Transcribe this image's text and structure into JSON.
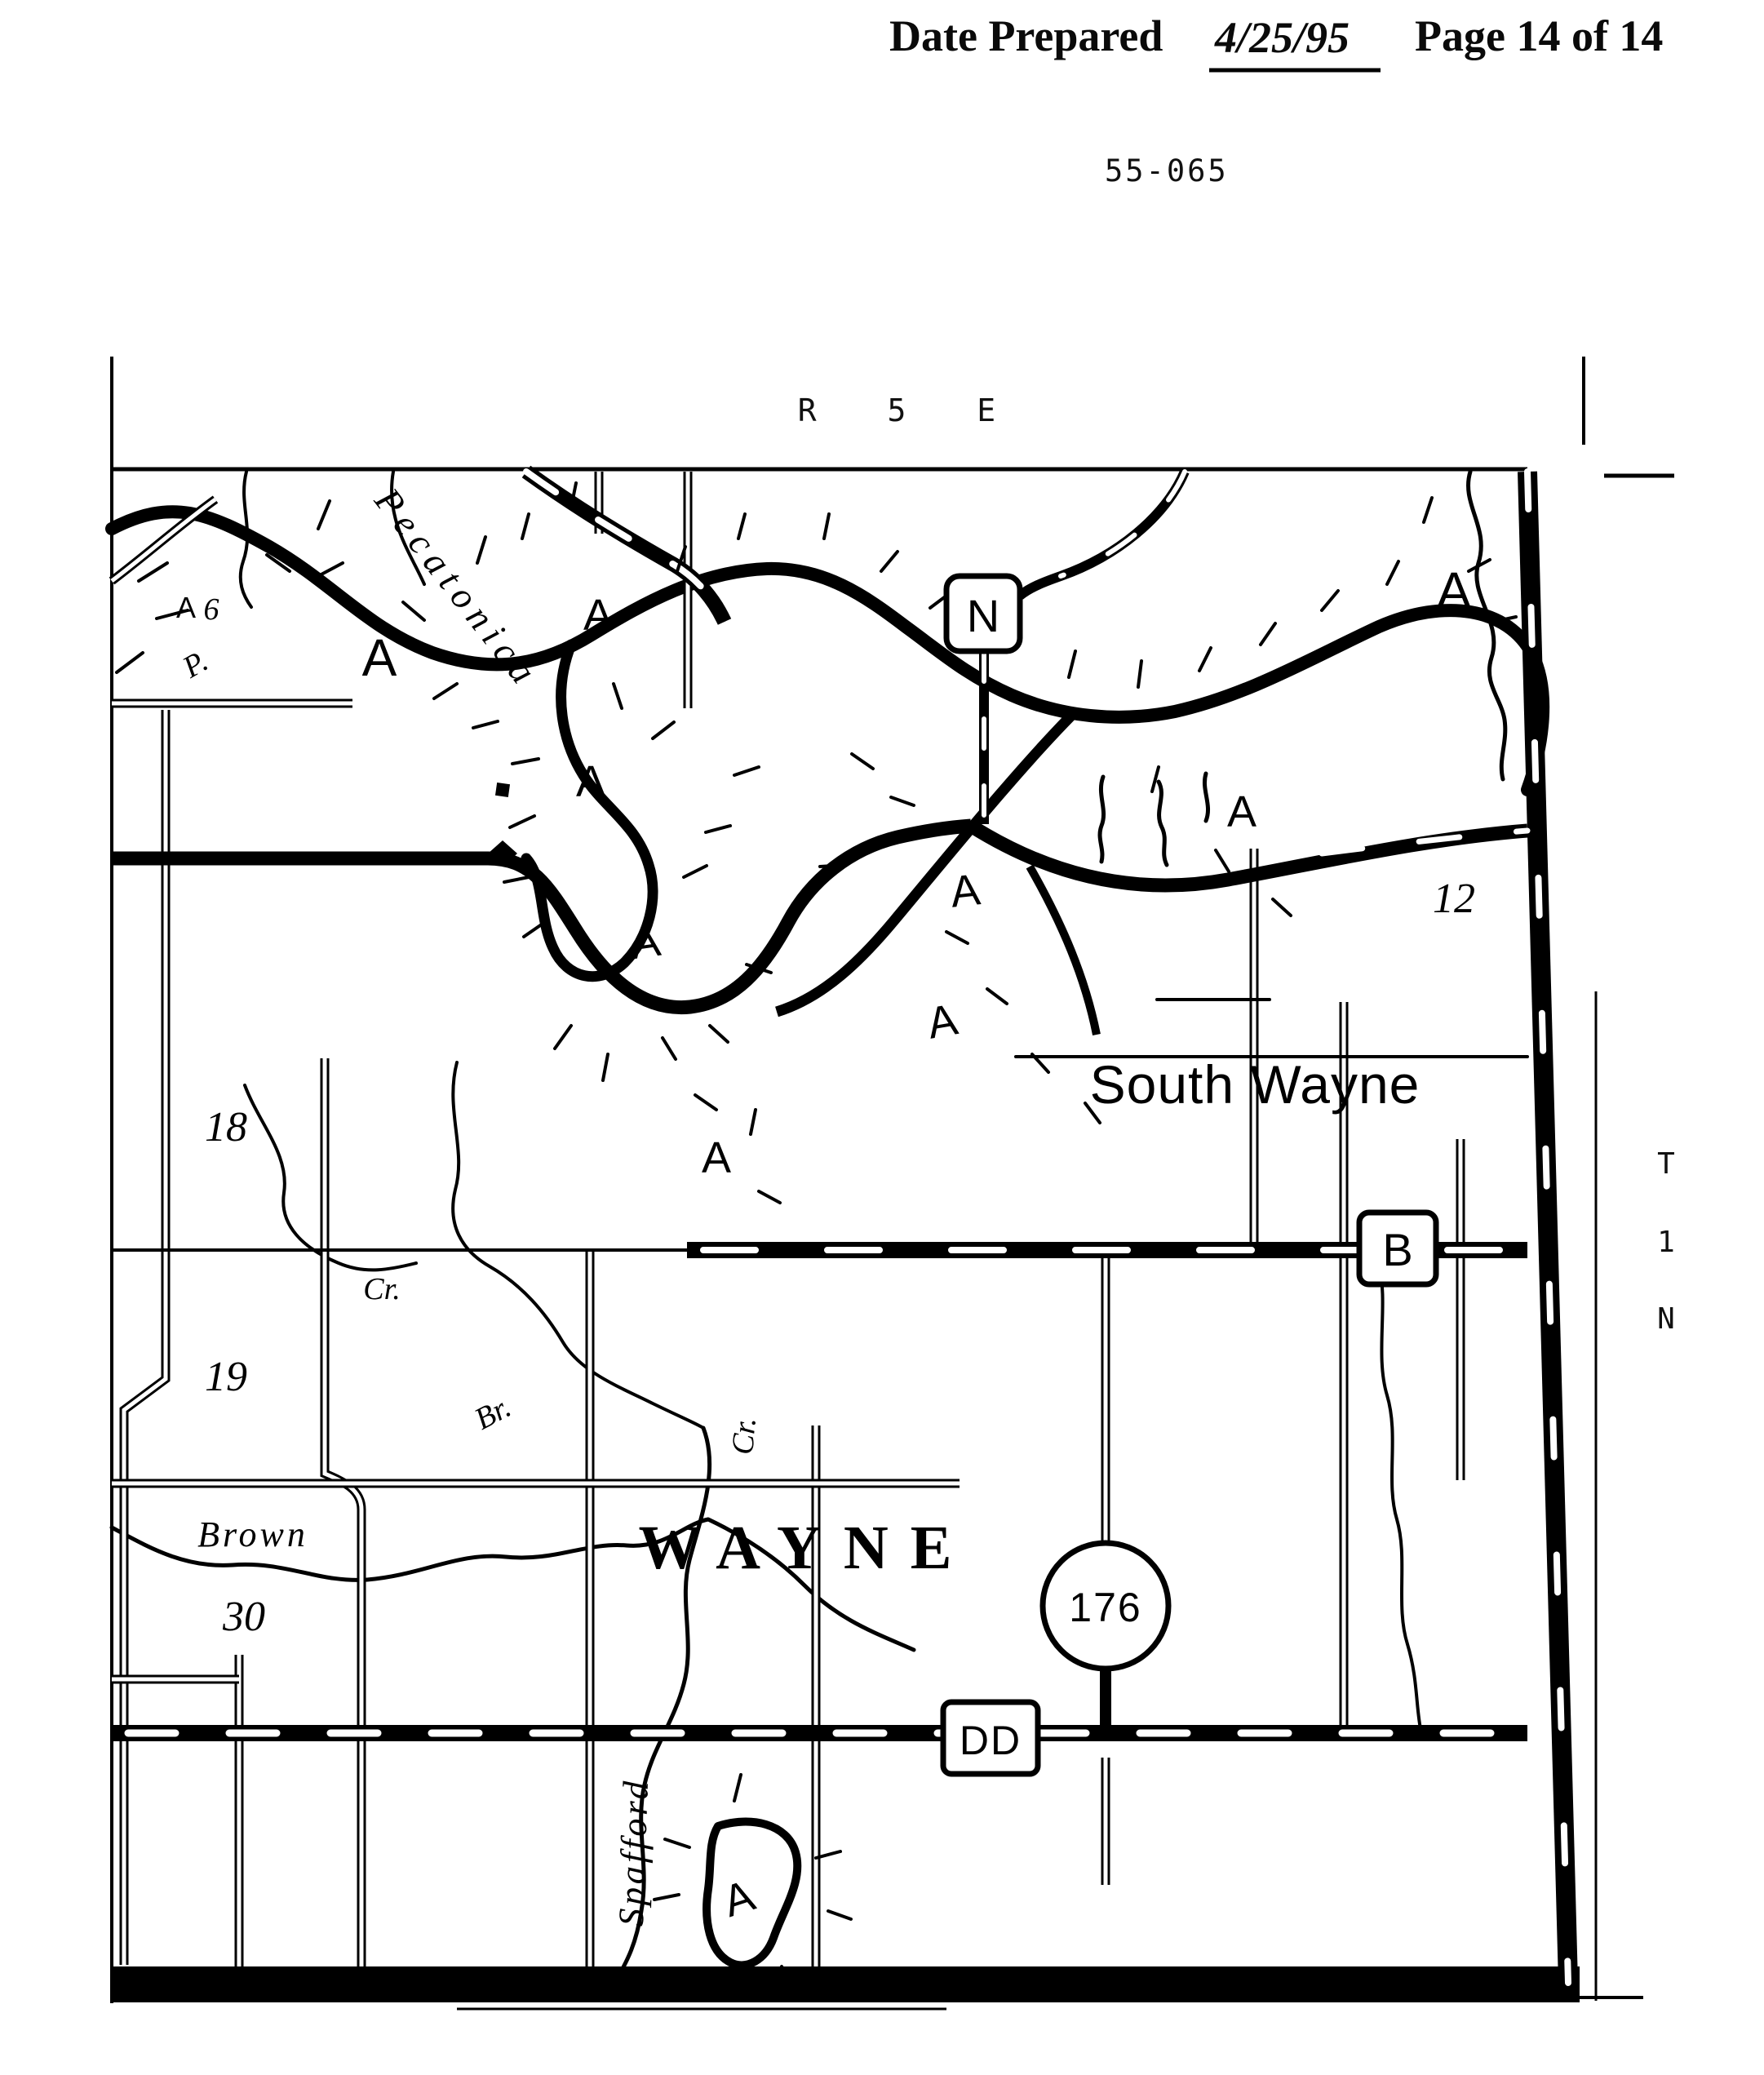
{
  "header": {
    "date_label": "Date Prepared",
    "date_value": "4/25/95",
    "page_label": "Page 14 of 14"
  },
  "doc_number": "55-065",
  "map": {
    "range_label": "R 5 E",
    "township_vertical": [
      "T",
      "1",
      "N"
    ],
    "towns": {
      "south_wayne": "South Wayne",
      "township_name": "WAYNE"
    },
    "sections": {
      "s12": "12",
      "s18": "18",
      "s19": "19",
      "s30": "30"
    },
    "highways": {
      "n": "N",
      "b": "B",
      "dd": "DD",
      "c176": "176"
    },
    "waters": {
      "pecatonica": "Pecatonica",
      "brown": "Brown",
      "spafford": "Spafford",
      "cr": "Cr.",
      "br": "Br.",
      "p": "P."
    },
    "zone_label": "A",
    "misc": {
      "six": "6"
    }
  }
}
